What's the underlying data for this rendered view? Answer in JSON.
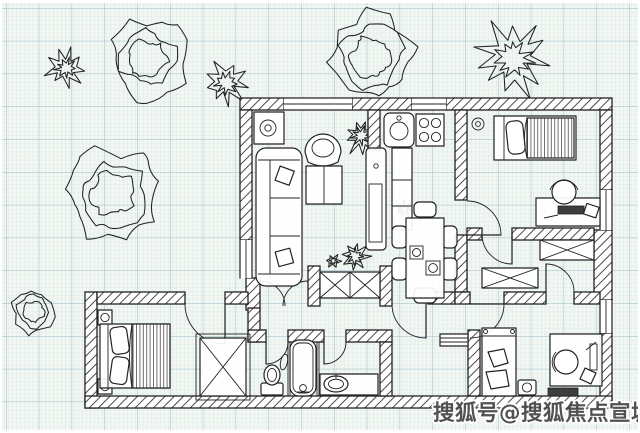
{
  "watermark": {
    "text": "搜狐号@搜狐焦点宣城站"
  },
  "colors": {
    "paper": "#f3f7f3",
    "grid_minor": "#c9dfda",
    "grid_major": "#8db3c6",
    "ink": "#222222",
    "watermark_fill": "#4a4a4a",
    "watermark_outline": "#ffffff"
  }
}
